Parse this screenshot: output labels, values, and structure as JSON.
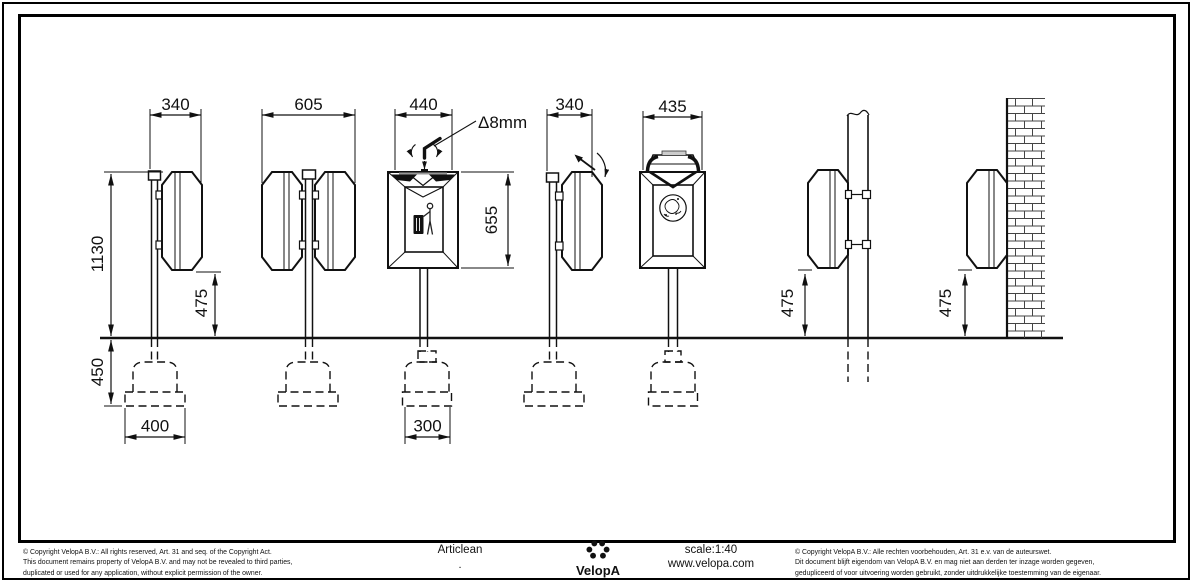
{
  "views": [
    {
      "id": "post-single-side",
      "dims": {
        "width": "340",
        "height": "1130",
        "mount_height": "475",
        "foundation_depth": "450",
        "foundation_width": "400"
      }
    },
    {
      "id": "post-double-side",
      "dims": {
        "width": "605"
      }
    },
    {
      "id": "front-closed",
      "dims": {
        "width": "440",
        "opening_height": "655",
        "key_note": "Δ8mm",
        "foundation_width": "300"
      }
    },
    {
      "id": "side-lid-open",
      "dims": {
        "width": "340"
      }
    },
    {
      "id": "front-lid-open",
      "dims": {
        "width": "435"
      }
    },
    {
      "id": "pole-mount",
      "dims": {
        "mount_height": "475"
      }
    },
    {
      "id": "wall-mount",
      "dims": {
        "mount_height": "475"
      }
    }
  ],
  "footer": {
    "copyright_en": [
      "©  Copyright VelopA B.V.: All rights reserved, Art. 31 and seq. of the Copyright Act.",
      "This document remains property of VelopA B.V. and may not be revealed to third parties,",
      "duplicated or used for any application, without explicit permission of the owner."
    ],
    "product_name": "Articlean",
    "product_note": ".",
    "brand": "VelopA",
    "scale": "scale:1:40",
    "website": "www.velopa.com",
    "copyright_nl": [
      "©  Copyright VelopA B.V.: Alle rechten voorbehouden, Art. 31 e.v. van de auteurswet.",
      "Dit document blijft eigendom van VelopA B.V. en mag niet aan derden ter inzage worden gegeven,",
      "gedupliceerd of voor uitvoering worden gebruikt, zonder uitdrukkelijke toestemming van de eigenaar."
    ]
  },
  "colors": {
    "line": "#111111",
    "background": "#ffffff"
  }
}
